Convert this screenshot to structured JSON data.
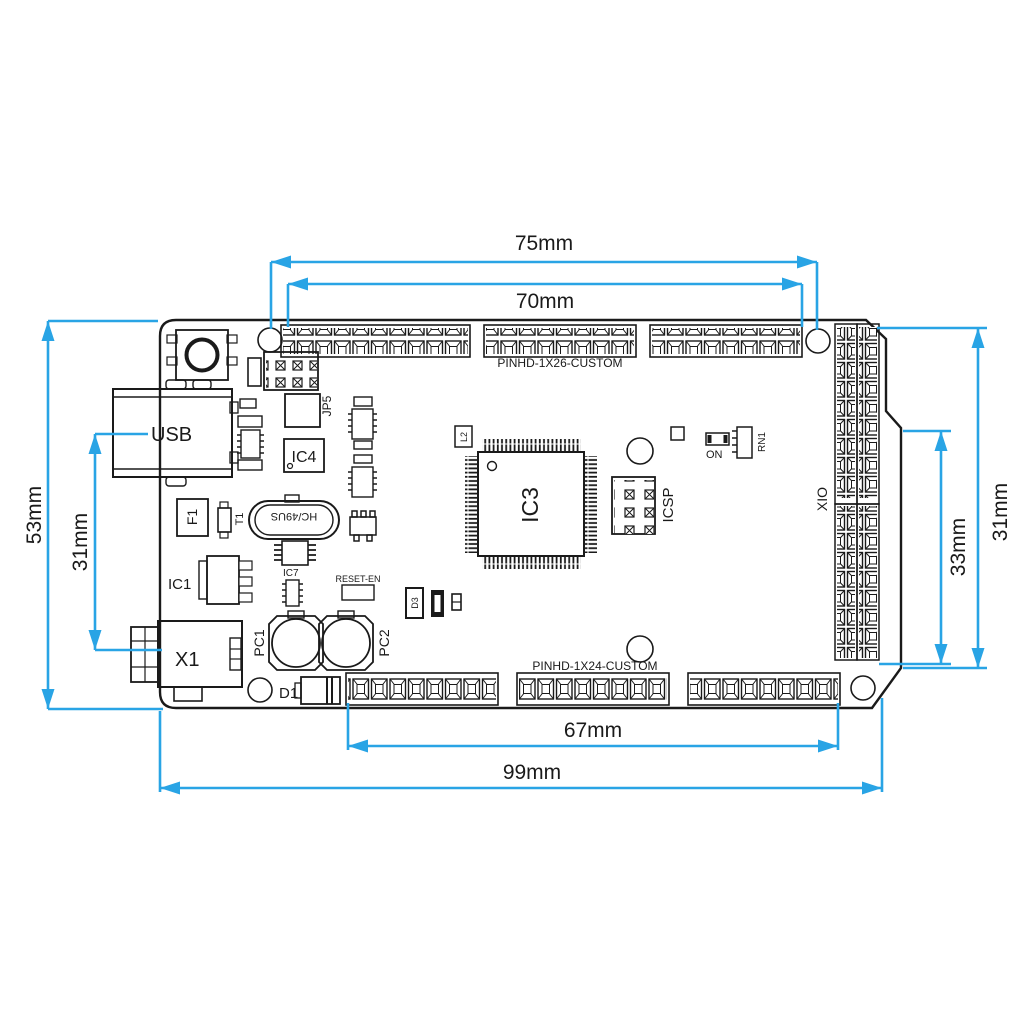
{
  "drawing": {
    "type": "PCB dimensioned outline drawing",
    "colors": {
      "dimension": "#29A4E5",
      "line": "#1A1A1A"
    }
  },
  "dimensions": {
    "top_outer": "75mm",
    "top_inner": "70mm",
    "left_total": "53mm",
    "left_connectors": "31mm",
    "right_total": "31mm",
    "right_header": "33mm",
    "bottom_header": "67mm",
    "bottom_total": "99mm"
  },
  "headers": {
    "top": "PINHD-1X26-CUSTOM",
    "bottom": "PINHD-1X24-CUSTOM",
    "right": "XIO",
    "icsp": "ICSP",
    "jp5": "JP5"
  },
  "components": {
    "usb": "USB",
    "power_jack": "X1",
    "fuse": "F1",
    "transistor": "T1",
    "regulator": "IC1",
    "mcu": "IC3",
    "usb_controller": "IC4",
    "ic7": "IC7",
    "crystal": "HC/49US",
    "reset_jumper": "RESET-EN",
    "cap_left": "PC1",
    "cap_right": "PC2",
    "diode": "D1",
    "diode_d3": "D3",
    "inductor": "L2",
    "power_led": "ON",
    "resistor_network": "RN1"
  }
}
